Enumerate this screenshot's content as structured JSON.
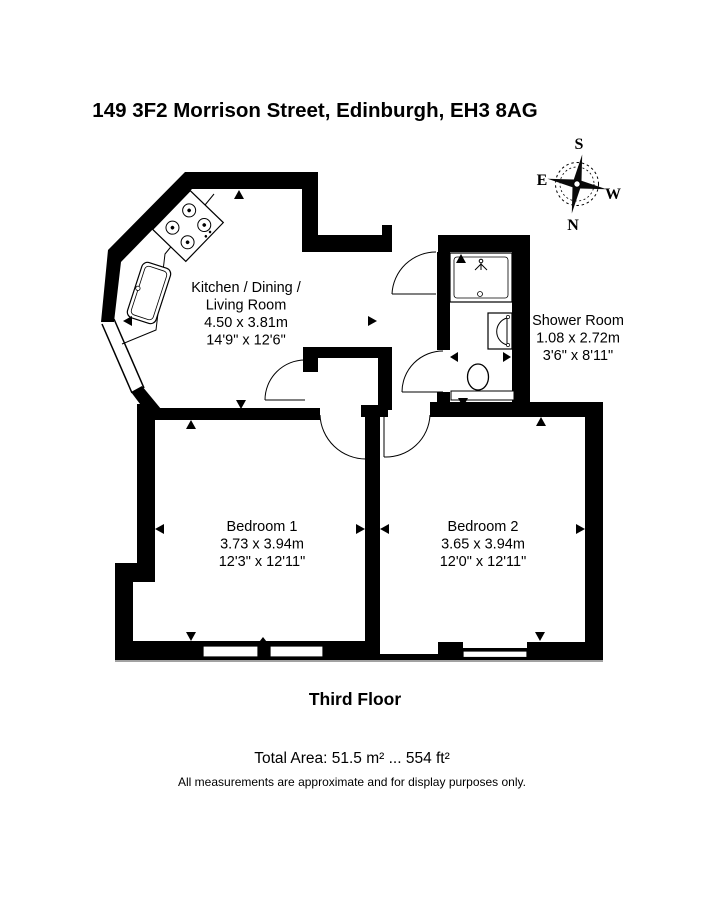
{
  "page": {
    "title": "149 3F2 Morrison Street, Edinburgh, EH3 8AG",
    "floor_label": "Third Floor",
    "total_area": "Total Area: 51.5 m² ... 554 ft²",
    "disclaimer": "All measurements are approximate and for display purposes only."
  },
  "compass": {
    "north": "N",
    "south": "S",
    "east": "E",
    "west": "W"
  },
  "rooms": {
    "kitchen": {
      "name_line1": "Kitchen / Dining /",
      "name_line2": "Living Room",
      "size_metric": "4.50 x 3.81m",
      "size_imperial": "14'9\" x 12'6\""
    },
    "shower_room": {
      "name": "Shower Room",
      "size_metric": "1.08 x 2.72m",
      "size_imperial": "3'6\" x 8'11\""
    },
    "bedroom1": {
      "name": "Bedroom 1",
      "size_metric": "3.73 x 3.94m",
      "size_imperial": "12'3\" x 12'11\""
    },
    "bedroom2": {
      "name": "Bedroom 2",
      "size_metric": "3.65 x 3.94m",
      "size_imperial": "12'0\" x 12'11\""
    }
  },
  "colors": {
    "wall": "#000000",
    "background": "#ffffff"
  }
}
